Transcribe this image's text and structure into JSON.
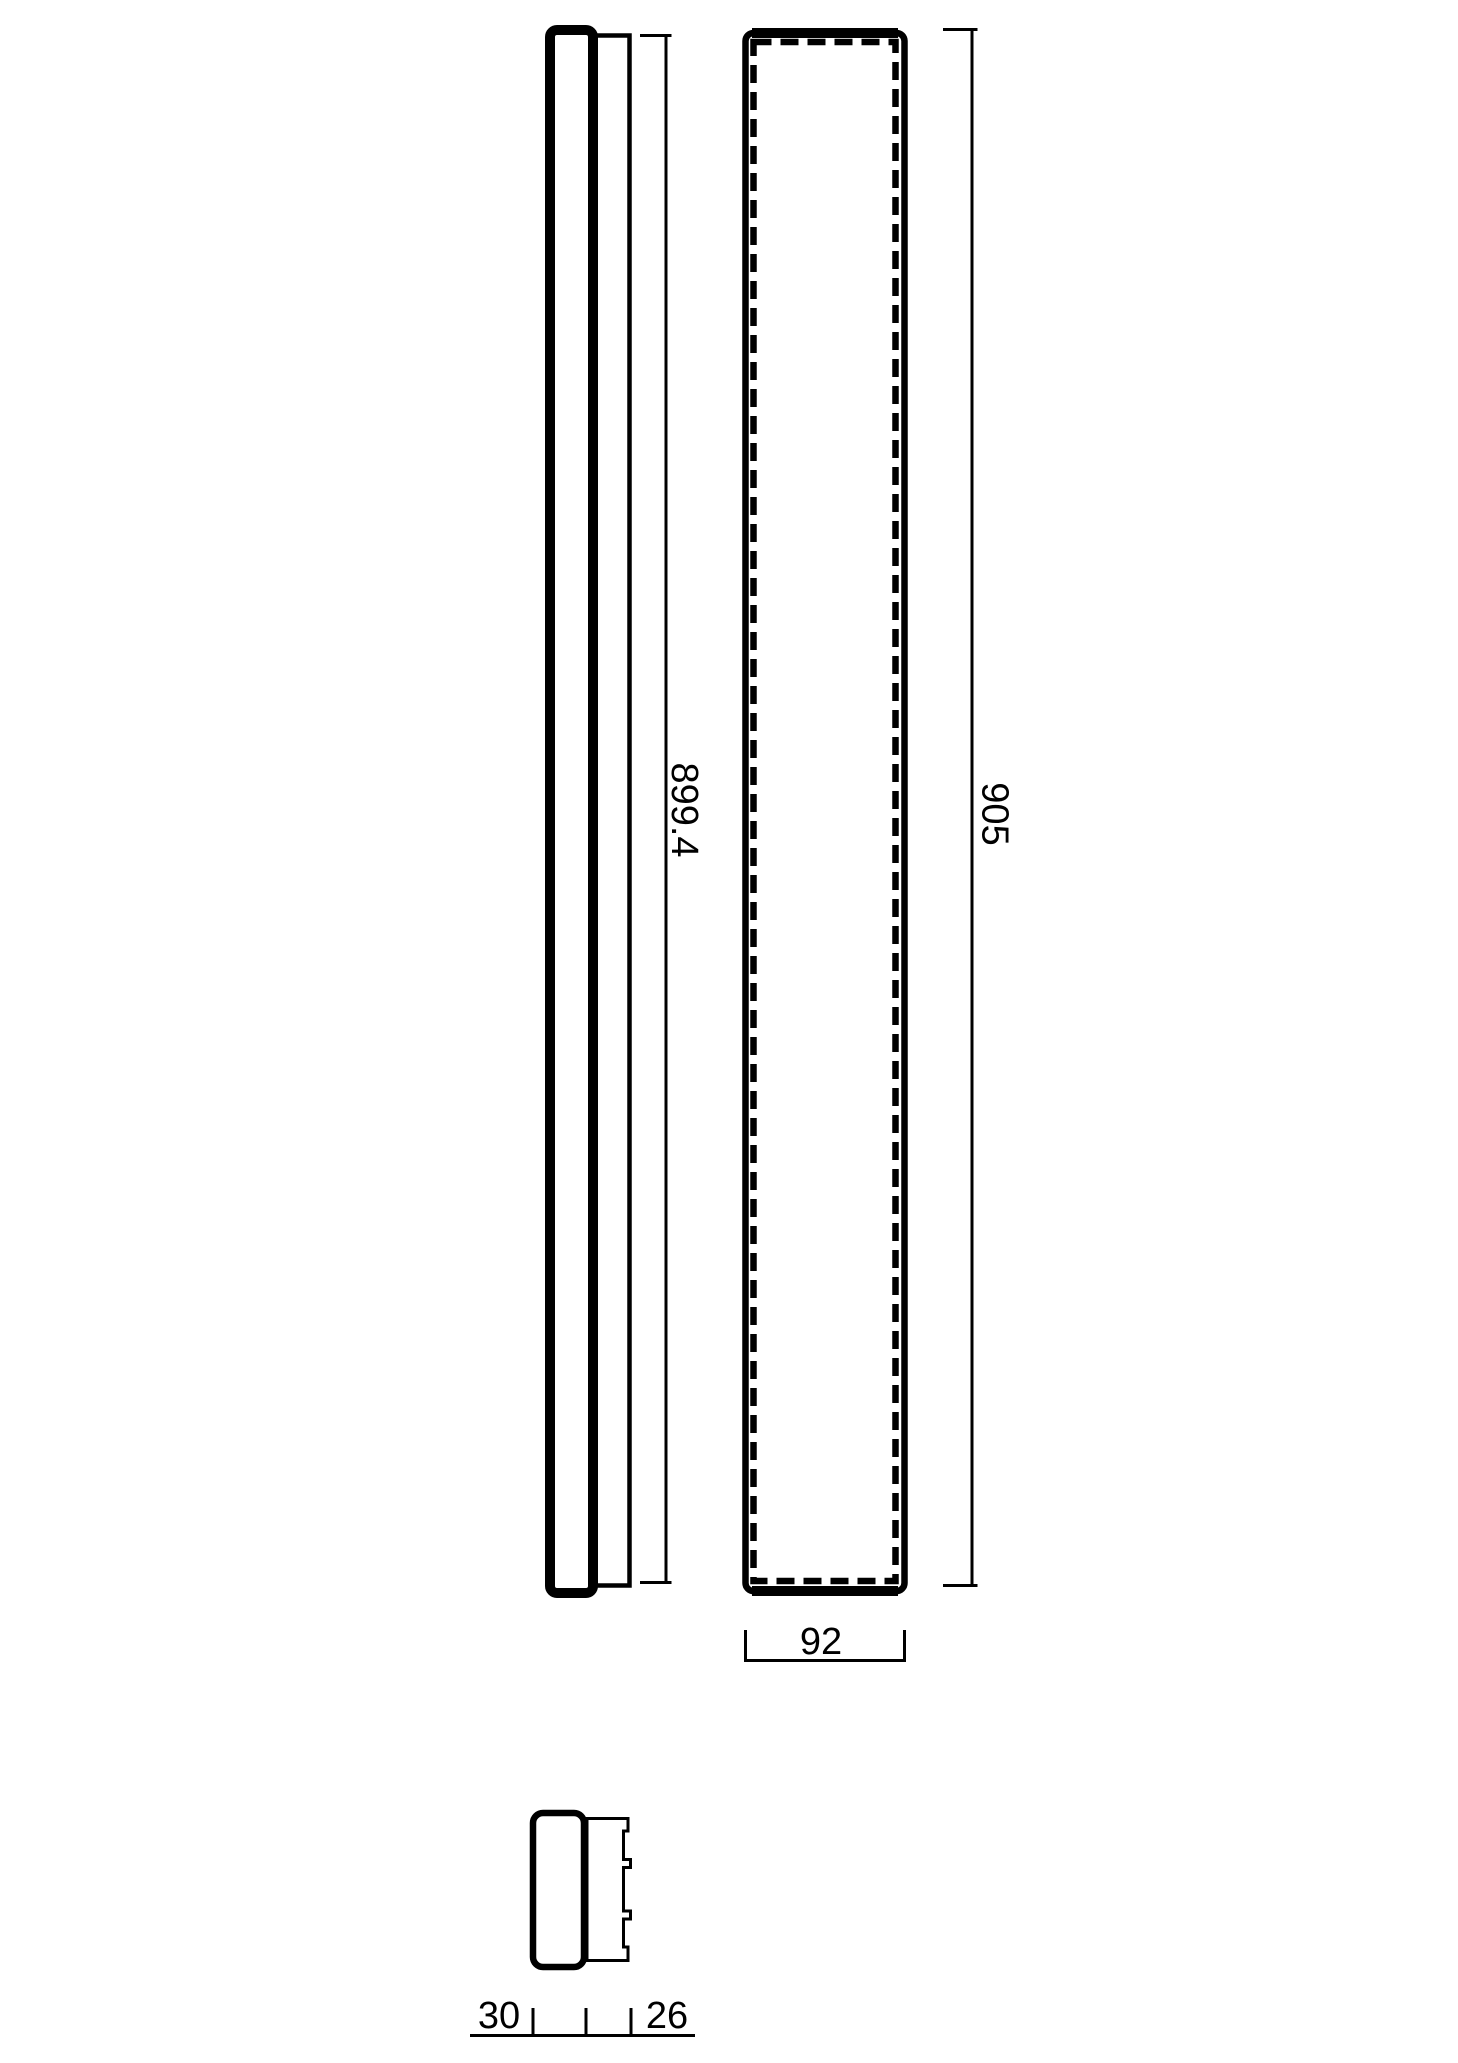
{
  "style": {
    "line_color": "#000000",
    "background_color": "#ffffff"
  },
  "dimensions": {
    "side_height": "899.4",
    "front_height": "905",
    "front_width": "92",
    "depth_cap": "30",
    "depth_mount": "26"
  }
}
